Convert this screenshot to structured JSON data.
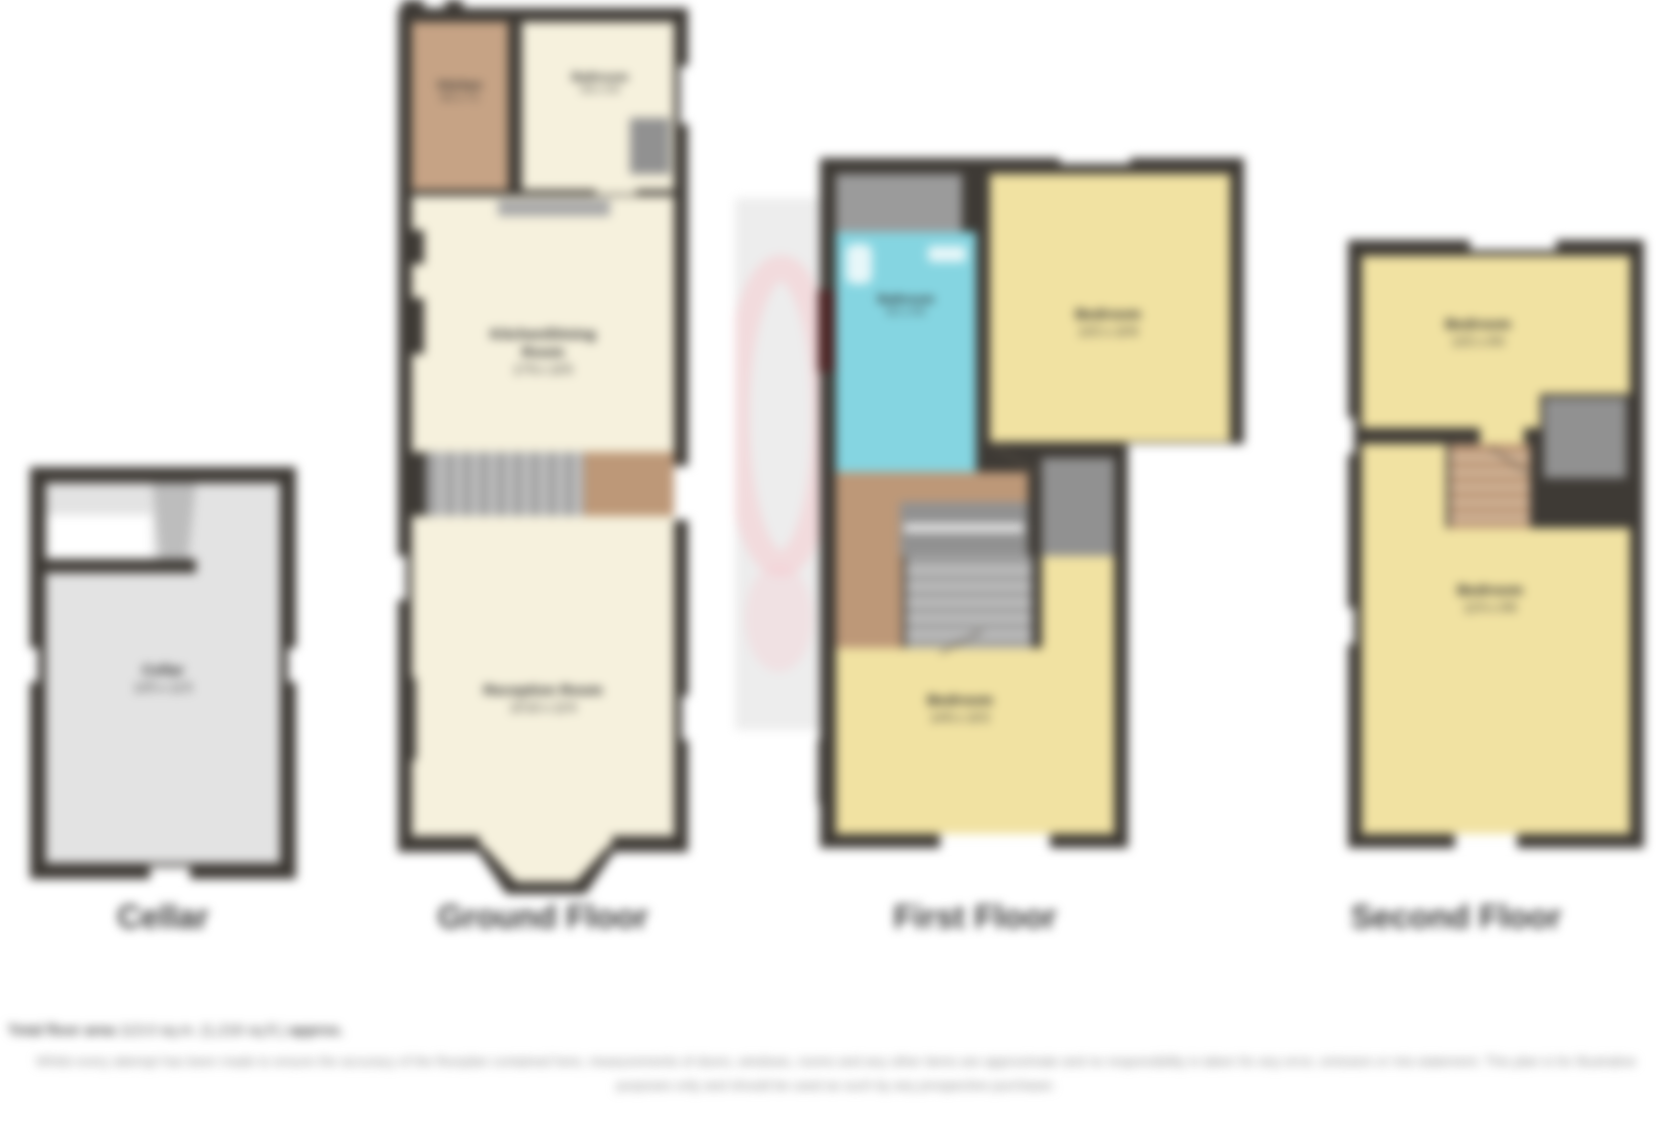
{
  "document": {
    "type": "property-floorplan-sheet"
  },
  "colors": {
    "wall": "#3e3a35",
    "cellar_fill": "#e3e3e3",
    "cream_room": "#f6f1dd",
    "kitchen_tan": "#c6a385",
    "bedroom_yellow": "#f1e2a2",
    "bathroom_cyan": "#85d5e1",
    "landing_tan": "#bd9878",
    "storage_gray": "#919191",
    "watermark_pink": "#f6ccd0",
    "watermark_strip": "#ededed",
    "title_text": "#3a3a3a",
    "footer_text": "#8d8d8d"
  },
  "plans": {
    "cellar": {
      "title": "Cellar",
      "room": {
        "name": "Cellar",
        "dims": "13'5 x 11'5"
      }
    },
    "ground": {
      "title": "Ground Floor",
      "kitchen": {
        "name": "Kitchen",
        "dims": "9'2 x 7'1"
      },
      "bathroom": {
        "name": "Bathroom",
        "dims": "6'8 x 5'9"
      },
      "dining": {
        "line1": "Kitchen/Dining",
        "line2": "Room",
        "dims": "17'9 x 10'5"
      },
      "reception": {
        "name": "Reception Room",
        "dims": "15'10 x 12'4"
      }
    },
    "first": {
      "title": "First Floor",
      "bathroom": {
        "name": "Bathroom",
        "dims": "8'2 x 5'6"
      },
      "bedroom_rear": {
        "name": "Bedroom",
        "dims": "13'2 x 10'9"
      },
      "bedroom_front": {
        "name": "Bedroom",
        "dims": "14'6 x 10'2"
      }
    },
    "second": {
      "title": "Second Floor",
      "bedroom_rear": {
        "name": "Bedroom",
        "dims": "13'2 x 9'0"
      },
      "bedroom_front": {
        "name": "Bedroom",
        "dims": "12'4 x 9'8"
      }
    }
  },
  "footer": {
    "total_prefix": "Total floor area",
    "total_value": "113.0 sq.m. (1,216 sq.ft.)",
    "total_suffix": "approx.",
    "disclaimer": "Whilst every attempt has been made to ensure the accuracy of the floorplan contained here, measurements of doors, windows, rooms and any other items are approximate and no responsibility is taken for any error, omission or mis-statement. This plan is for illustrative purposes only and should be used as such by any prospective purchaser."
  }
}
